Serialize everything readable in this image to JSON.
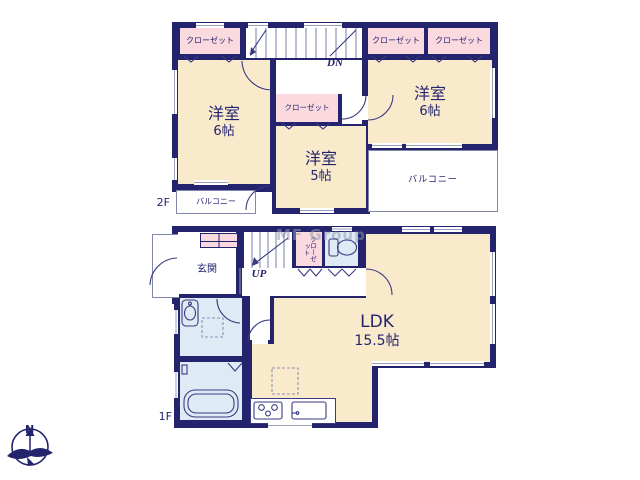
{
  "watermark": "MF Group",
  "compass": {
    "north_label": "N"
  },
  "floor_2f": {
    "floor_label": "2F",
    "stairs_label": "DN",
    "closet_top_left": "クローゼット",
    "closet_top_right_1": "クローゼット",
    "closet_top_right_2": "クローゼット",
    "closet_middle": "クローゼット",
    "room_left": {
      "name": "洋室",
      "size": "6帖"
    },
    "room_middle": {
      "name": "洋室",
      "size": "5帖"
    },
    "room_right": {
      "name": "洋室",
      "size": "6帖"
    },
    "balcony_left": "バルコニー",
    "balcony_right": "バルコニー"
  },
  "floor_1f": {
    "floor_label": "1F",
    "stairs_label": "UP",
    "entrance": "玄関",
    "closet": "クローゼット",
    "ldk": {
      "name": "LDK",
      "size": "15.5帖"
    }
  },
  "colors": {
    "wall": "#23236E",
    "room_cream": "#F8EACB",
    "closet_pink": "#FADADE",
    "wet_area_blue": "#DEEBF5"
  }
}
